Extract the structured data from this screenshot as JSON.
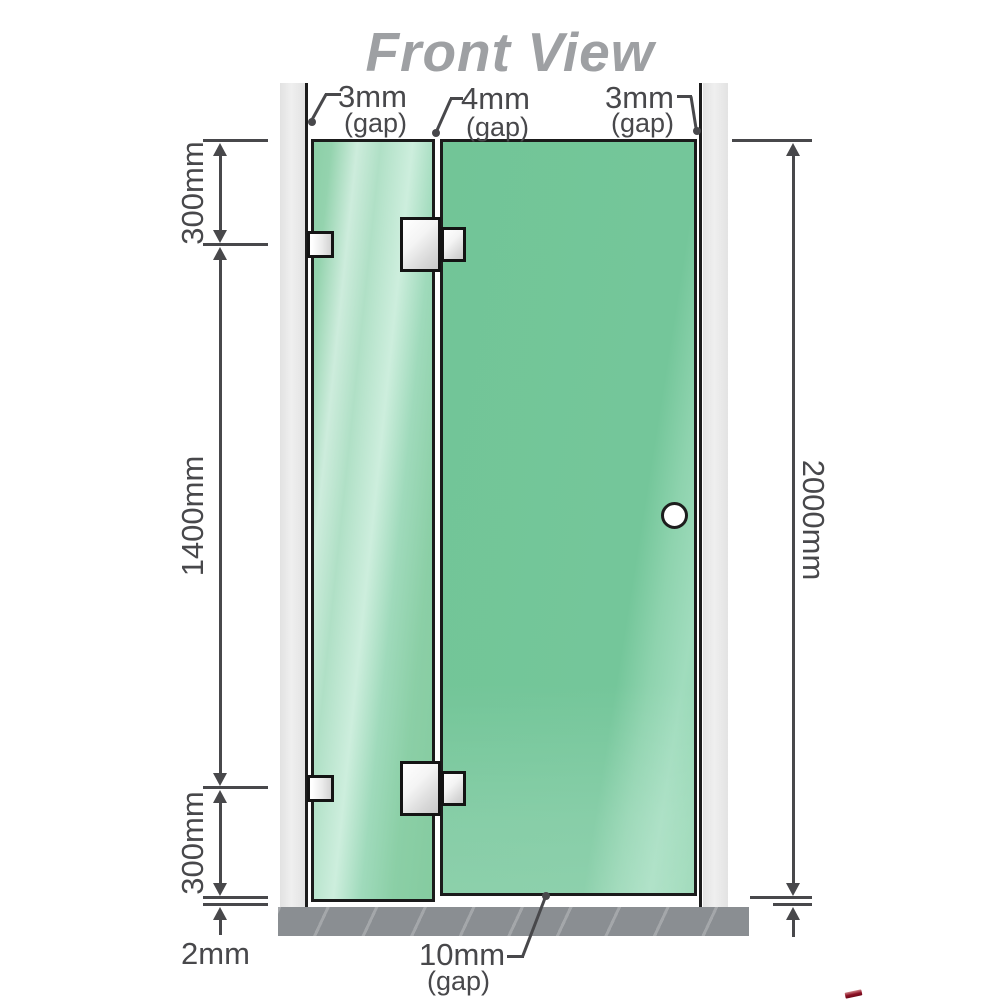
{
  "title": "Front View",
  "colors": {
    "glass_green": "#74c69a",
    "glass_highlight": "#cdecdc",
    "wall_channel_gray": "#e8e8e8",
    "floor_gray": "#8a8e92",
    "dimension_gray": "#48484b",
    "title_gray": "#9ea0a3",
    "hardware_silver": "#e8e8e8",
    "logo_red": "#8c1024"
  },
  "gaps": {
    "top_left": {
      "value": "3mm",
      "note": "(gap)"
    },
    "top_middle": {
      "value": "4mm",
      "note": "(gap)"
    },
    "top_right": {
      "value": "3mm",
      "note": "(gap)"
    },
    "bottom": {
      "value": "10mm",
      "note": "(gap)"
    }
  },
  "dimensions": {
    "left_top": "300mm",
    "left_middle": "1400mm",
    "left_bottom": "300mm",
    "floor_gap": "2mm",
    "total_height": "2000mm"
  }
}
